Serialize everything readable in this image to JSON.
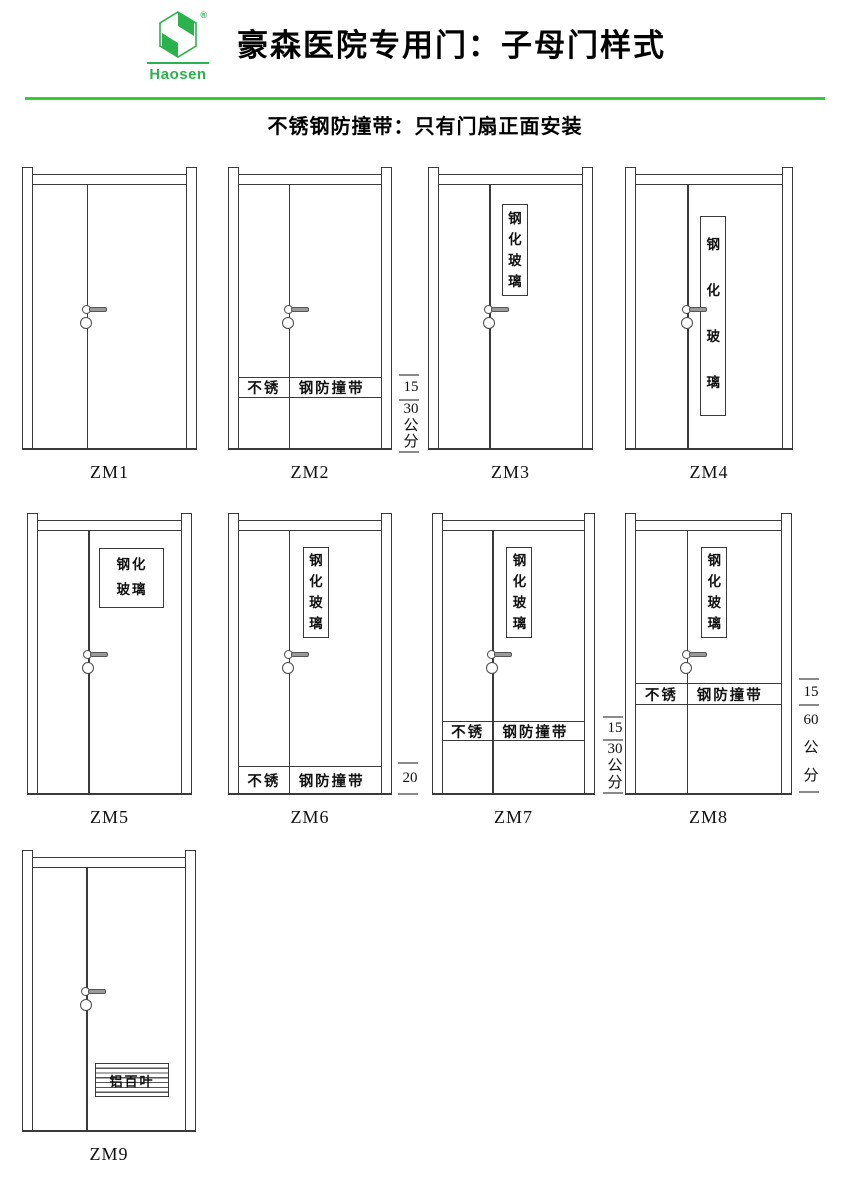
{
  "header": {
    "brand": "Haosen",
    "registered": "®",
    "title": "豪森医院专用门：子母门样式",
    "subtitle": "不锈钢防撞带：只有门扇正面安装"
  },
  "colors": {
    "brand_green": "#2bb24c",
    "rule_green": "#33cc33",
    "line": "#3a3a3a"
  },
  "doors": [
    {
      "label": "ZM1"
    },
    {
      "label": "ZM2",
      "band": {
        "left": "不锈",
        "right": "钢防撞带"
      },
      "dim": {
        "band_height": "15",
        "offset": "30公分"
      }
    },
    {
      "label": "ZM3",
      "window": "钢化玻璃"
    },
    {
      "label": "ZM4",
      "window": "钢化玻璃"
    },
    {
      "label": "ZM5",
      "window": "钢化玻璃"
    },
    {
      "label": "ZM6",
      "window": "钢化玻璃",
      "band": {
        "left": "不锈",
        "right": "钢防撞带"
      },
      "dim": {
        "band_height": "20"
      }
    },
    {
      "label": "ZM7",
      "window": "钢化玻璃",
      "band": {
        "left": "不锈",
        "right": "钢防撞带"
      },
      "dim": {
        "band_height": "15",
        "offset": "30公分"
      }
    },
    {
      "label": "ZM8",
      "window": "钢化玻璃",
      "band": {
        "left": "不锈",
        "right": "钢防撞带"
      },
      "dim": {
        "band_height": "15",
        "offset": "60公分"
      }
    },
    {
      "label": "ZM9",
      "louver": "铝百叶"
    }
  ]
}
